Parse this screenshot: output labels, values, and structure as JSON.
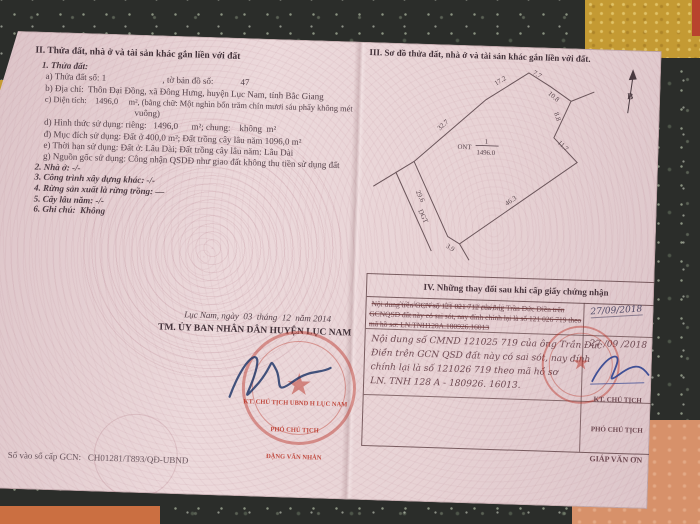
{
  "colors": {
    "paper_pink": "#e6d0d3",
    "stamp_red": "#bf3b2d",
    "ink_blue": "#2e4290",
    "granite_dark": "#2b2d2a",
    "fabric_mustard": "#c49a33",
    "fabric_salmon": "#d7916a"
  },
  "icons": {
    "star": "★",
    "north_label": "B"
  },
  "section2": {
    "heading": "II. Thửa đất, nhà ở và tài sản khác gắn liền với đất",
    "sub_heading": "1. Thửa đất:",
    "items": [
      "a) Thửa đất số: 1                         , tờ bản đồ số:            47",
      "b) Địa chỉ:  Thôn Đại Đồng, xã Đông Hưng, huyện Lục Nam, tỉnh Bắc Giang",
      "c) Diện tích:    1496,0     m², (bằng chữ: Một nghìn bốn trăm chín mươi sáu phẩy không mét",
      "vuông)",
      "d) Hình thức sử dụng: riêng:   1496,0      m²; chung:    không  m²",
      "đ) Mục đích sử dụng: Đất ở 400,0 m²; Đất trồng cây lâu năm 1096,0 m²",
      "e) Thời hạn sử dụng: Đất ở: Lâu Dài; Đất trồng cây lâu năm: Lâu Dài",
      "g) Nguồn gốc sử dụng: Công nhận QSDĐ như giao đất không thu tiền sử dụng đất",
      "2. Nhà ở: -/-",
      "3. Công trình xây dựng khác: -/-",
      "4. Rừng sản xuất là rừng trồng: —",
      "5. Cây lâu năm: -/-",
      "6. Ghi chú:  Không"
    ]
  },
  "signature_block": {
    "date_line": "Lục Nam, ngày  03  tháng  12  năm 2014",
    "committee": "TM. ỦY BAN NHÂN DÂN HUYỆN LỤC NAM",
    "stamp_line1": "KT. CHỦ TỊCH UBND H LỤC NAM",
    "stamp_line2": "PHÓ CHỦ TỊCH",
    "stamp_line3": "ĐẶNG VĂN NHÀN"
  },
  "serial_line": "Số vào sổ cấp GCN:   CH01281/T893/QĐ-UBND",
  "section3": {
    "heading": "III. Sơ đồ thửa đất, nhà ở và tài sản khác gắn liền với đất.",
    "north_label": "B",
    "parcel": {
      "land_code": "ONT",
      "plot_number": "1",
      "area": "1496.0",
      "road_label": "DGT",
      "edges": [
        "32.7",
        "17.2",
        "7.7",
        "10.8",
        "8.8",
        "11.7",
        "46.3",
        "3.9",
        "29.6"
      ]
    }
  },
  "section4": {
    "heading": "IV. Những thay đổi sau khi cấp giấy chứng nhận",
    "col1_header": "Nội dung thay đổi và cơ sở pháp lý",
    "row1": {
      "l1": "Nội dung trên GCN số 121 021 712 của ông Trần Đức Điền trên",
      "l2": "GCNQSD đất này có sai sót, nay đính chính lại là số 121 026 719 theo",
      "l3": "mã hồ sơ: LN.TNH128A.180926.16013",
      "date": "27/09/2018"
    },
    "row2": {
      "l1": "Nội dung số CMND 121025 719 của ông Trần Đức",
      "l2": "Điền trên GCN QSD đất này có sai sót, nay đính",
      "l3": "chính lại là số 121026 719 theo mã hồ sơ",
      "l4": "LN. TNH 128 A - 180926. 16013.",
      "date": "27 /09 /2018",
      "stamp_line1": "KT. CHỦ TỊCH",
      "stamp_line2": "PHÓ CHỦ TỊCH",
      "stamp_line3": "GIÁP VĂN ƠN"
    }
  }
}
